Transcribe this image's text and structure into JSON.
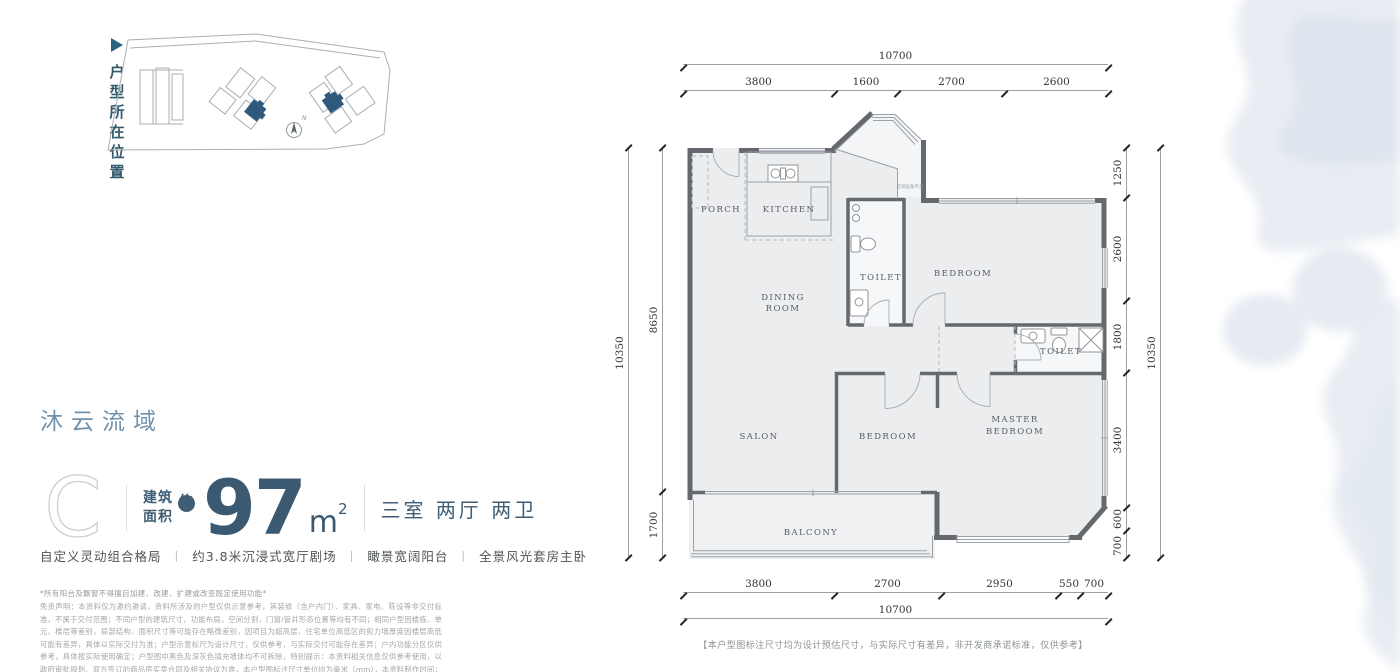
{
  "location_tag": {
    "label": "户型所在位置"
  },
  "title": {
    "text": "沐云流域"
  },
  "unit": {
    "type_letter": "C",
    "area_prefix_1": "建筑",
    "area_prefix_2": "面积",
    "approx_badge": "约",
    "area_value": "97",
    "area_unit_base": "m",
    "area_unit_exp": "2",
    "rooms_summary": "三室 两厅 两卫",
    "feature_separator": "|",
    "features": [
      "自定义灵动组合格局",
      "约3.8米沉浸式宽厅剧场",
      "瞰景宽阔阳台",
      "全景风光套房主卧"
    ]
  },
  "disclaimer": {
    "line": "*所有阳台及飘窗不得擅自加建、改建、扩建或改变既定使用功能*",
    "body": "免责声明：本资料仅为邀约邀请，资料所涉及的户型仅供示意参考，其装修（含户内门）、家具、家电、陈设等非交付标准，不属于交付范围；不同户型的建筑尺寸，功能布局，空间分割，门窗/管井形态位置等均有不同；相同户型因楼栋、单元、楼层等差别，局部结构、面积尺寸等可能存在略微差别，因项目为超高层，住宅单位高低区的剪力墙厚度因楼层高低可能有差异，具体以实际交付为准；户型示意标尺为设计尺寸，仅供参考，与实际交付可能存在差异；户内功能分区仅供参考，具体按实际使用确定；户型图中黑色及深灰色填充墙体均不可拆除，特别提示：本资料相关信息仅供参考使用，以政府审批规划、双方签订的商品房买卖合同及相关协议为准，本户型图标注尺寸单位均为毫米（mm），本资料制作时间：2023年3月。"
  },
  "floor_plan": {
    "rooms": {
      "porch": "PORCH",
      "kitchen": "KITCHEN",
      "dining_1": "DINING",
      "dining_2": "ROOM",
      "toilet_a": "TOILET",
      "bedroom_a": "BEDROOM",
      "toilet_b": "TOILET",
      "salon": "SALON",
      "bedroom_b": "BEDROOM",
      "master_1": "MASTER",
      "master_2": "BEDROOM",
      "balcony": "BALCONY"
    },
    "ac_platform": "空调设备平台",
    "dims": {
      "top_total": "10700",
      "top_segments": [
        "3800",
        "1600",
        "2700",
        "2600"
      ],
      "left_total": "10350",
      "left_segments": [
        "8650",
        "1700"
      ],
      "right_total": "10350",
      "right_segments": [
        "1250",
        "2600",
        "1800",
        "3400",
        "600",
        "700"
      ],
      "bottom_total": "10700",
      "bottom_segments": [
        "3800",
        "2700",
        "2950",
        "550",
        "700"
      ]
    },
    "note": "【本户型图标注尺寸均为设计预估尺寸，与实际尺寸有差异，非开发商承诺标准，仅供参考】"
  },
  "colors": {
    "accent_dark": "#3f5e75",
    "title_blue": "#7192ad",
    "wall_gray": "#65686c",
    "highlight_building": "#2f5a7d"
  }
}
